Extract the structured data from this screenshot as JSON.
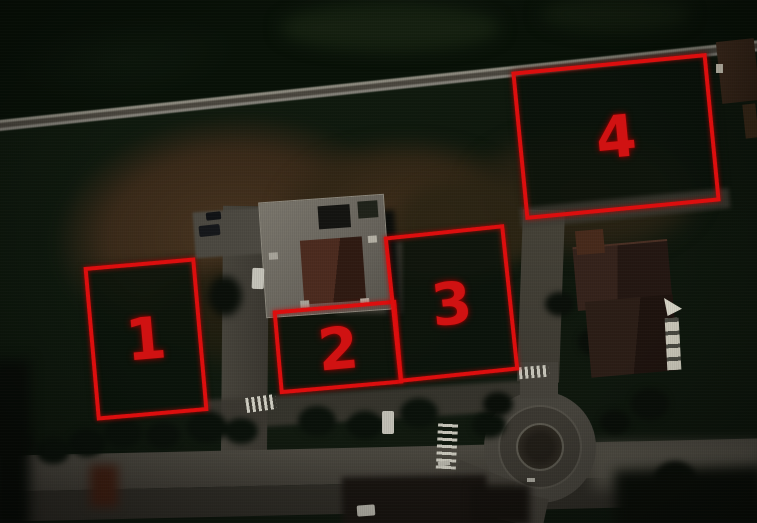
{
  "annotation": {
    "color": "#dc0e0e",
    "plots": [
      {
        "label": "1"
      },
      {
        "label": "2"
      },
      {
        "label": "3"
      },
      {
        "label": "4"
      }
    ]
  }
}
